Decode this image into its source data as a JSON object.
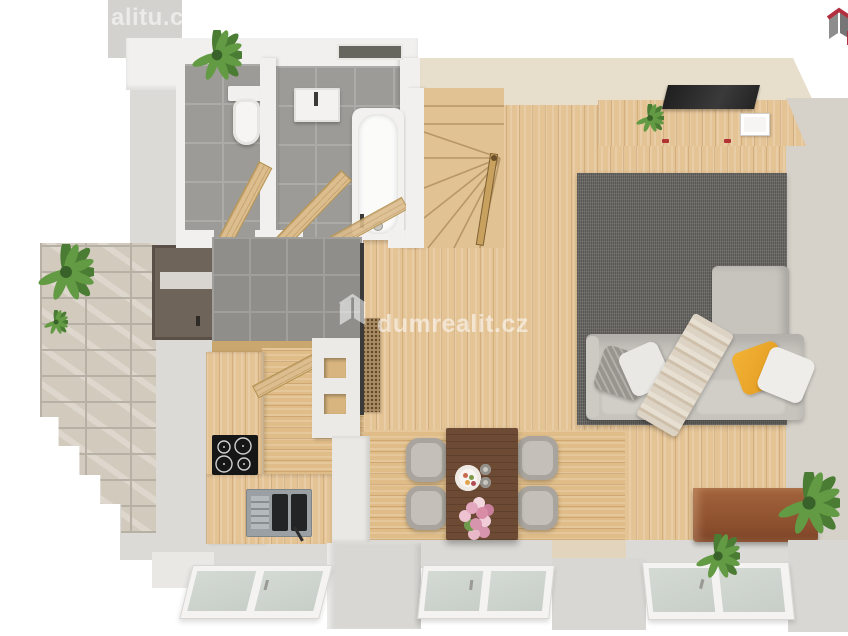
{
  "meta": {
    "image_kind": "3d-top-down-floor-plan-render"
  },
  "watermarks": {
    "center": {
      "text": "dumrealit.cz",
      "icon": "dumrealit-house-logo"
    },
    "top_left": {
      "text": "alitu.cz"
    },
    "top_right": {
      "icon": "dumrealit-house-logo-red-gray"
    }
  },
  "scene": {
    "rooms": [
      "wc",
      "bathroom",
      "entry-hall",
      "staircase",
      "kitchen",
      "dining-area",
      "living-room"
    ],
    "furniture": [
      "toilet",
      "vanity-sink",
      "bathtub",
      "winder-stairs",
      "tv-sideboard",
      "tv",
      "l-shaped-sofa",
      "area-rug",
      "throw-pillows",
      "plaid-throw",
      "dining-table",
      "dining-chairs",
      "cooktop",
      "kitchen-sink",
      "kitchen-counter",
      "copper-chest",
      "potted-plants",
      "entrance-door",
      "french-windows"
    ]
  },
  "palette": {
    "background": "#ffffff",
    "wall_light": "#dbdad6",
    "wall_cream": "#e7decb",
    "wall_white": "#f1f0ee",
    "wood_floor": "#e4c395",
    "wood_furniture": "#dcbd8d",
    "tile_gray": "#9c9b97",
    "tile_entry": "#8f8e8a",
    "rug_gray": "#6a6965",
    "sofa_gray": "#c7c4be",
    "pillow_yellow": "#efa62f",
    "table_walnut": "#6d4a33",
    "chest_copper": "#9a5c36",
    "plant_green": "#55843c",
    "logo_red": "#b22f3f",
    "logo_gray": "#8b8b8b"
  }
}
